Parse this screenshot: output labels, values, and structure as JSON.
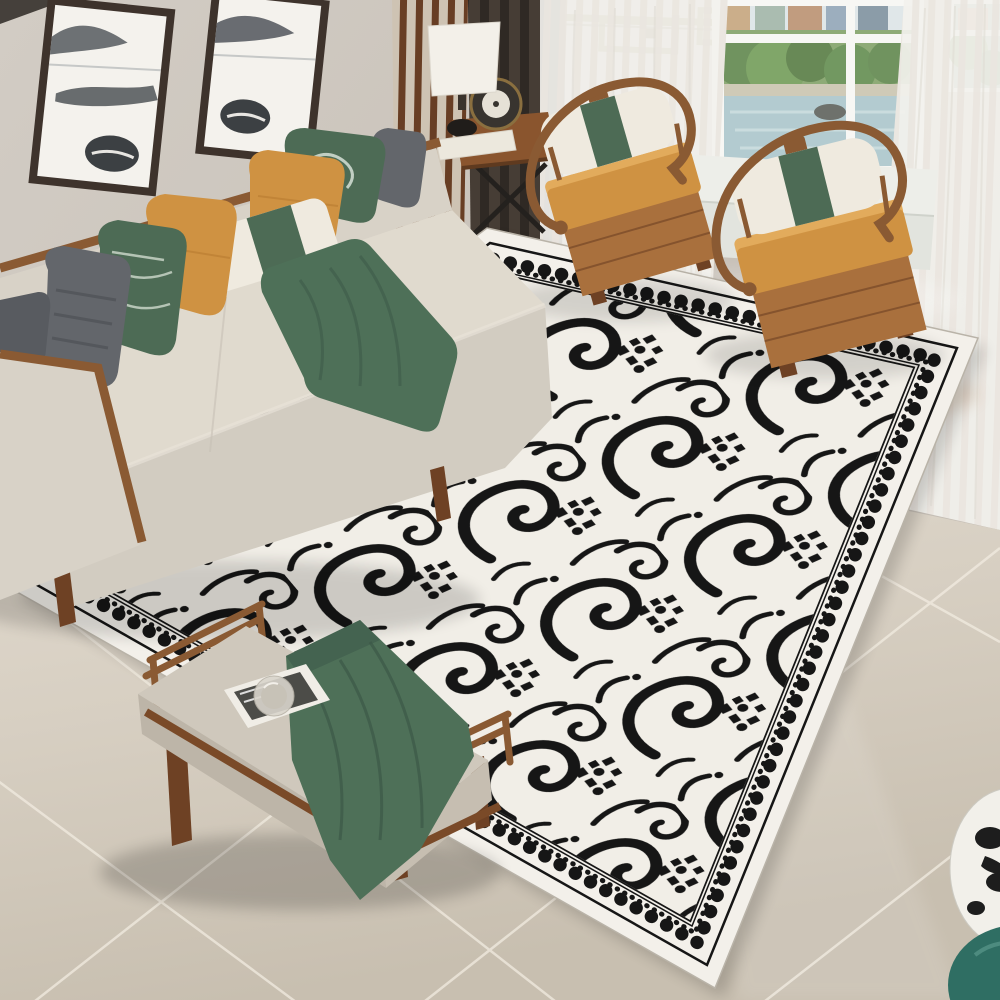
{
  "meta": {
    "description": "Bright living room photo: black and white scroll-pattern area rug on glossy marble floor, beige wood-trim sofa with green, mustard and gray pillows, two horseshoe wood armchairs with mustard cushions, upholstered bench with green throw and magazine, side table with drum lamp, dark and sheer curtains, city-park window view, ink-wash wall art and brass ceiling light"
  },
  "palette": {
    "wall": "#d2ccc4",
    "wallDeep": "#c5beb5",
    "ceiling": "#45403b",
    "wood": "#8a5a33",
    "woodDark": "#6e4124",
    "woodLight": "#a9703d",
    "slatCream": "#ddd2c2",
    "curtainDark": "#463d35",
    "curtainDark2": "#2f2924",
    "sheer": "#f4f2ee",
    "sheerShade": "#eae6e0",
    "sofaFabric": "#d8d2c7",
    "sofaSeat": "#e0dace",
    "pillowGray": "#63666b",
    "pillowGreen": "#4d6b55",
    "greenDark": "#3e5a49",
    "mustard": "#cf9242",
    "mustardLight": "#e2ab5c",
    "whitePillow": "#efeadf",
    "rugBase": "#f3f0ea",
    "rugField": "#f1eee7",
    "rugInk": "#161616",
    "floorLight": "#e6dfd4",
    "floorDark": "#c8bfb0",
    "grout": "#f2ece1",
    "benchCushion": "#cfc8bc",
    "blanket": "#4e7058",
    "brass": "#8f7c48",
    "viewGreen": "#5f8a4c",
    "viewWater": "#a9c4ca",
    "seatWhite": "#edeee9",
    "teal": "#2f6e63"
  },
  "scene": {
    "objects": [
      {
        "id": "room",
        "label": "living room product photo"
      },
      {
        "id": "wall",
        "label": "greige wall"
      },
      {
        "id": "ceiling-edge",
        "label": "dark ceiling edge"
      },
      {
        "id": "wall-art-left",
        "label": "ink-wash wall art left panel"
      },
      {
        "id": "wall-art-right",
        "label": "ink-wash wall art right panel"
      },
      {
        "id": "wood-slat-panel",
        "label": "vertical wood slat panel"
      },
      {
        "id": "chandelier",
        "label": "brass geometric ceiling light"
      },
      {
        "id": "dark-curtain",
        "label": "dark brown curtain"
      },
      {
        "id": "sheer-curtain-left",
        "label": "white sheer curtain left"
      },
      {
        "id": "sheer-curtain-right",
        "label": "white sheer curtain right"
      },
      {
        "id": "window",
        "label": "white framed window"
      },
      {
        "id": "window-view",
        "label": "city park and water view"
      },
      {
        "id": "window-seat",
        "label": "white window seat"
      },
      {
        "id": "marble-floor",
        "label": "glossy marble tile floor"
      },
      {
        "id": "area-rug",
        "label": "black and white scroll pattern rug"
      },
      {
        "id": "rug-pattern",
        "label": "black scrollwork rug field"
      },
      {
        "id": "sofa",
        "label": "beige sofa with wood trim"
      },
      {
        "id": "sofa-pillows",
        "label": "sofa throw pillows"
      },
      {
        "id": "green-runner",
        "label": "green throw on sofa seat"
      },
      {
        "id": "side-table",
        "label": "wood side table with X legs"
      },
      {
        "id": "table-lamp",
        "label": "white drum table lamp"
      },
      {
        "id": "desk-clock",
        "label": "round desk clock"
      },
      {
        "id": "armchair-left",
        "label": "horseshoe armchair left"
      },
      {
        "id": "armchair-right",
        "label": "horseshoe armchair right"
      },
      {
        "id": "bench",
        "label": "upholstered wood bench"
      },
      {
        "id": "green-blanket",
        "label": "green blanket on bench"
      },
      {
        "id": "magazine",
        "label": "magazine on bench"
      },
      {
        "id": "glass-plate",
        "label": "round glass plate"
      },
      {
        "id": "vase",
        "label": "spotted vase and teal ornament"
      },
      {
        "id": "floor-reflections",
        "label": "floor reflections"
      }
    ]
  }
}
